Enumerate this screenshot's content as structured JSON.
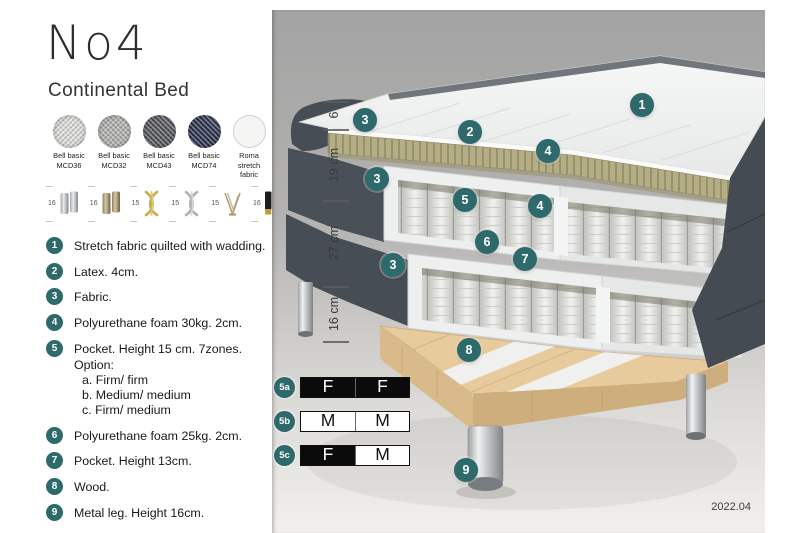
{
  "product": {
    "title": "No4",
    "subtitle": "Continental Bed"
  },
  "fabric_swatches": [
    {
      "name": "Bell basic",
      "code": "MCD36",
      "color": "#dedfdb",
      "texture": "weave"
    },
    {
      "name": "Bell basic",
      "code": "MCD32",
      "color": "#b1b2ae",
      "texture": "weave"
    },
    {
      "name": "Bell basic",
      "code": "MCD43",
      "color": "#55575b",
      "texture": "weave"
    },
    {
      "name": "Bell basic",
      "code": "MCD74",
      "color": "#2e3450",
      "texture": "weave"
    },
    {
      "name": "Roma",
      "code": "stretch fabric",
      "color": "#f5f5f4",
      "texture": "plain"
    }
  ],
  "leg_options": [
    {
      "height": "16",
      "style": "cylinder-silver"
    },
    {
      "height": "16",
      "style": "cylinder-bronze"
    },
    {
      "height": "15",
      "style": "twist-gold"
    },
    {
      "height": "15",
      "style": "twist-silver"
    },
    {
      "height": "15",
      "style": "hairpin"
    },
    {
      "height": "16",
      "style": "cylinder-black-gold"
    }
  ],
  "features": [
    {
      "num": "1",
      "text": "Stretch fabric quilted with wadding."
    },
    {
      "num": "2",
      "text": "Latex. 4cm."
    },
    {
      "num": "3",
      "text": "Fabric."
    },
    {
      "num": "4",
      "text": "Polyurethane foam 30kg. 2cm."
    },
    {
      "num": "5",
      "text": "Pocket. Height 15 cm. 7zones. Option:",
      "options": [
        "a. Firm/ firm",
        "b. Medium/ medium",
        "c. Firm/ medium"
      ]
    },
    {
      "num": "6",
      "text": "Polyurethane foam 25kg. 2cm."
    },
    {
      "num": "7",
      "text": "Pocket. Height 13cm."
    },
    {
      "num": "8",
      "text": "Wood."
    },
    {
      "num": "9",
      "text": "Metal leg. Height 16cm."
    }
  ],
  "diagram": {
    "dimensions": [
      {
        "label": "6",
        "top": 91,
        "bottom": 119
      },
      {
        "label": "19 cm",
        "top": 119,
        "bottom": 190
      },
      {
        "label": "27 cm",
        "top": 190,
        "bottom": 276
      },
      {
        "label": "16 cm",
        "top": 276,
        "bottom": 331
      }
    ],
    "callouts": [
      {
        "n": "1",
        "x": 370,
        "y": 95
      },
      {
        "n": "2",
        "x": 198,
        "y": 122
      },
      {
        "n": "3",
        "x": 93,
        "y": 110
      },
      {
        "n": "4",
        "x": 276,
        "y": 141
      },
      {
        "n": "3",
        "x": 105,
        "y": 169
      },
      {
        "n": "5",
        "x": 193,
        "y": 190
      },
      {
        "n": "4",
        "x": 268,
        "y": 196
      },
      {
        "n": "6",
        "x": 215,
        "y": 232
      },
      {
        "n": "7",
        "x": 253,
        "y": 249
      },
      {
        "n": "3",
        "x": 121,
        "y": 255
      },
      {
        "n": "8",
        "x": 197,
        "y": 340
      },
      {
        "n": "9",
        "x": 194,
        "y": 460
      }
    ],
    "firmness_options": [
      {
        "id": "5a",
        "cells": [
          {
            "label": "F",
            "filled": true
          },
          {
            "label": "F",
            "filled": true
          }
        ]
      },
      {
        "id": "5b",
        "cells": [
          {
            "label": "M",
            "filled": false
          },
          {
            "label": "M",
            "filled": false
          }
        ]
      },
      {
        "id": "5c",
        "cells": [
          {
            "label": "F",
            "filled": true
          },
          {
            "label": "M",
            "filled": false
          }
        ]
      }
    ],
    "version": "2022.04"
  },
  "colors": {
    "accent_teal": "#2e696b",
    "upholstery_gray": "#4a5058",
    "latex_tan": "#b4ad85",
    "wood": "#e7cb9c",
    "spring_white": "#f1f1ef",
    "table_black": "#0b0b0b"
  }
}
